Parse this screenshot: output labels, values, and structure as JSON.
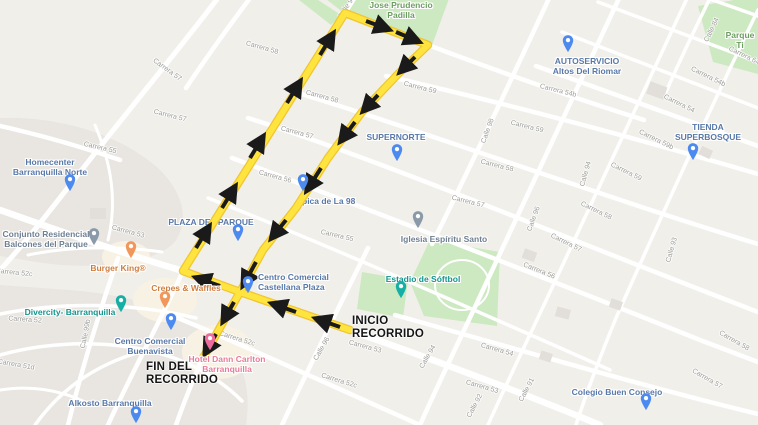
{
  "colors": {
    "map-bg": "#F1EFEA",
    "road-white": "#FFFFFF",
    "park-green": "#CDE9C1",
    "block-gray": "#E9E6E1",
    "building-gray": "#E2DFDA",
    "route-yellow": "#FFE33E",
    "route-casing": "#EFC62F",
    "poi-blue": "#5878A8",
    "poi-orange": "#CF7D3E",
    "poi-teal": "#12948C",
    "poi-gray": "#6E7F92",
    "poi-pink": "#E87B9A",
    "poi-green": "#6D9C63",
    "pin-blue": "#4D8AF0",
    "pin-orange": "#F2975B",
    "pin-teal": "#16AFA6",
    "pin-gray": "#8A9AA8",
    "pin-pink": "#EE6C9C",
    "street-gray": "#9B9B98",
    "annotation-black": "#141414"
  },
  "annotations": {
    "start": "INICIO\nRECORRIDO",
    "end": "FIN DEL\nRECORRIDO"
  },
  "streets": [
    "Calle 9",
    "Carrera 57",
    "Carrera 57",
    "Carrera 58",
    "Carrera 58",
    "Carrera 59",
    "Carrera 57",
    "Carrera 56",
    "Carrera 55",
    "Carrera 55",
    "Carrera 53",
    "Carrera 52c",
    "Carrera 52",
    "Carrera 51d",
    "Calle 99b",
    "Carrera 52c",
    "Calle 96",
    "Carrera 52c",
    "Carrera 53",
    "Calle 94",
    "Carrera 53",
    "Calle 92",
    "Calle 91",
    "Carrera 54",
    "Carrera 57",
    "Carrera 58",
    "Calle 98",
    "Carrera 59",
    "Carrera 58",
    "Carrera 57",
    "Calle 96",
    "Calle 94",
    "Carrera 59b",
    "Carrera 59",
    "Carrera 58",
    "Carrera 57",
    "Calle 93",
    "Carrera 56",
    "Carrera 54b",
    "Carrera 54b",
    "Carrera 54",
    "Calle 84",
    "Carrera 64"
  ],
  "pois": [
    {
      "name": "Jose Prudencio\nPadilla",
      "category": "park"
    },
    {
      "name": "Parque Ti",
      "category": "park"
    },
    {
      "name": "AUTOSERVICIO\nAltos Del Riomar",
      "category": "store"
    },
    {
      "name": "TIENDA\nSUPERBOSQUE",
      "category": "store"
    },
    {
      "name": "SUPERNORTE",
      "category": "supermarket"
    },
    {
      "name": "pica de La 98",
      "category": "supermarket"
    },
    {
      "name": "Iglesia Espíritu Santo",
      "category": "church"
    },
    {
      "name": "Estadio de Sóftbol",
      "category": "stadium"
    },
    {
      "name": "PLAZA DEL PARQUE",
      "category": "plaza"
    },
    {
      "name": "Homecenter\nBarranquilla Norte",
      "category": "store"
    },
    {
      "name": "Conjunto Residencial\nBalcones del Parque",
      "category": "residential"
    },
    {
      "name": "Burger King®",
      "category": "restaurant"
    },
    {
      "name": "Crepes & Waffles",
      "category": "restaurant"
    },
    {
      "name": "Centro Comercial\nCastellana Plaza",
      "category": "mall"
    },
    {
      "name": "Divercity- Barranquilla",
      "category": "attraction"
    },
    {
      "name": "Centro Comercial\nBuenavista",
      "category": "mall"
    },
    {
      "name": "Hotel Dann Carlton\nBarranquilla",
      "category": "hotel"
    },
    {
      "name": "Alkosto Barranquilla",
      "category": "store"
    },
    {
      "name": "Colegio Buen Consejo",
      "category": "school"
    }
  ]
}
